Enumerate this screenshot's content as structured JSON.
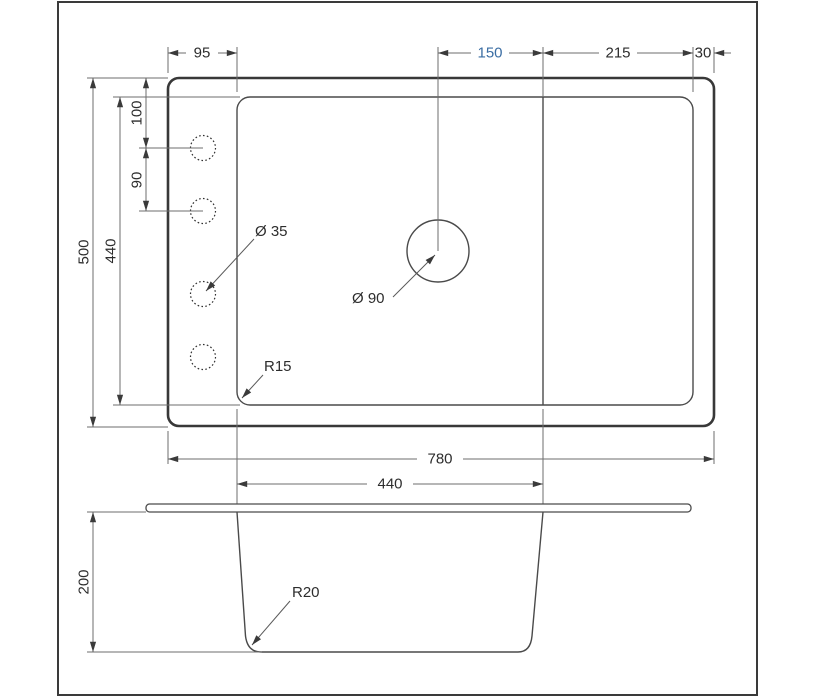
{
  "palette": {
    "background": "#ffffff",
    "frame_stroke": "#3a3a3a",
    "outline_thick": "#383838",
    "outline_thin": "#4a4a4a",
    "dimension_lines": "#6e6e6e",
    "text": "#2d2d2d",
    "accent_text": "#3a6da3"
  },
  "top_view": {
    "dimensions": {
      "left_margin": "95",
      "center_to_bowl_edge": "150",
      "drainboard_width": "215",
      "right_margin": "30",
      "outer_depth": "500",
      "bowl_depth": "440",
      "edge_to_first_hole": "100",
      "hole_pitch": "90",
      "outer_width": "780",
      "bowl_width": "440"
    },
    "callouts": {
      "faucet_hole": "Ø 35",
      "drain_hole": "Ø 90",
      "bowl_corner_radius": "R15"
    }
  },
  "side_view": {
    "dimensions": {
      "bowl_depth": "200"
    },
    "callouts": {
      "bottom_radius": "R20"
    }
  }
}
